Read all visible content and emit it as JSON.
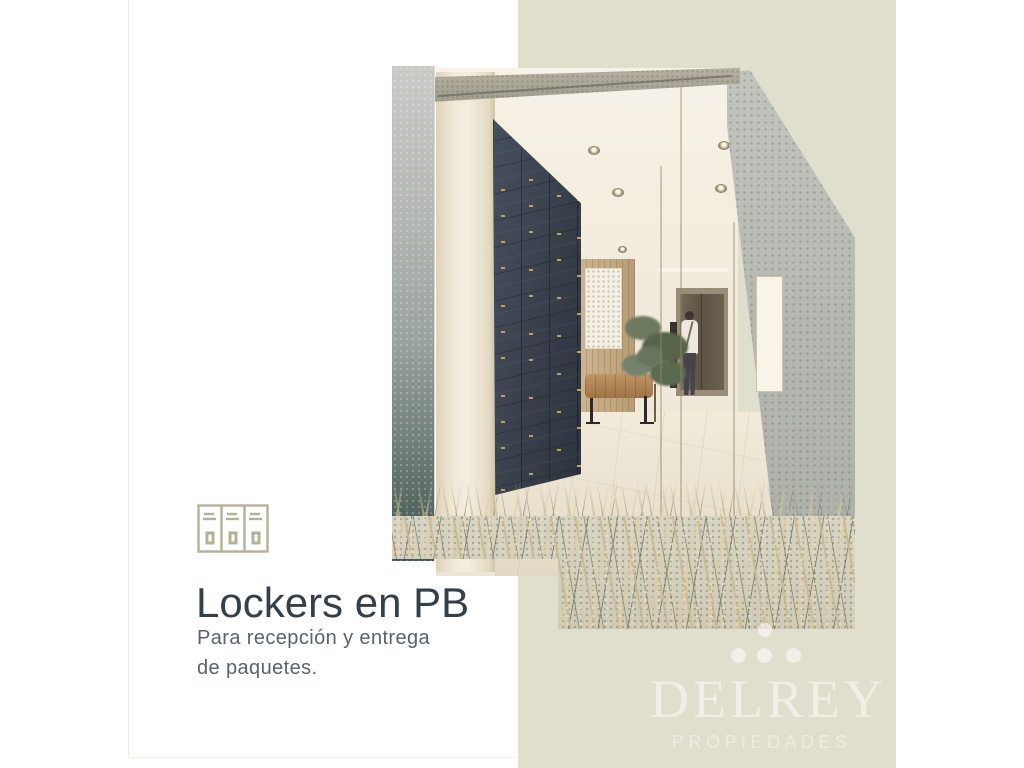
{
  "page": {
    "background": "#ffffff"
  },
  "side_panel": {
    "color": "#e0decc"
  },
  "caption": {
    "icon": "lockers-icon",
    "icon_color": "#b7b098",
    "heading": "Lockers en PB",
    "heading_color": "#343f49",
    "body": [
      "Para recepción y entrega",
      "de paquetes."
    ],
    "body_color": "#5a636b"
  },
  "brand": {
    "name": "DELREY",
    "tagline": "PROPIEDADES",
    "watermark_color": "rgba(255,255,255,0.5)",
    "mark": "four-dots-logo"
  },
  "illustration": {
    "alt": "Architectural render of a residential lobby: dark blue wall of numbered parcel lockers with brass number plates, beige walls, mirror wall, bronze elevator with a man standing in front, leather bench, botanical artwork, small tree and ornamental grasses over paving in the foreground",
    "locker_wall_color": "#39414d",
    "locker_number_color": "#c49f63"
  }
}
